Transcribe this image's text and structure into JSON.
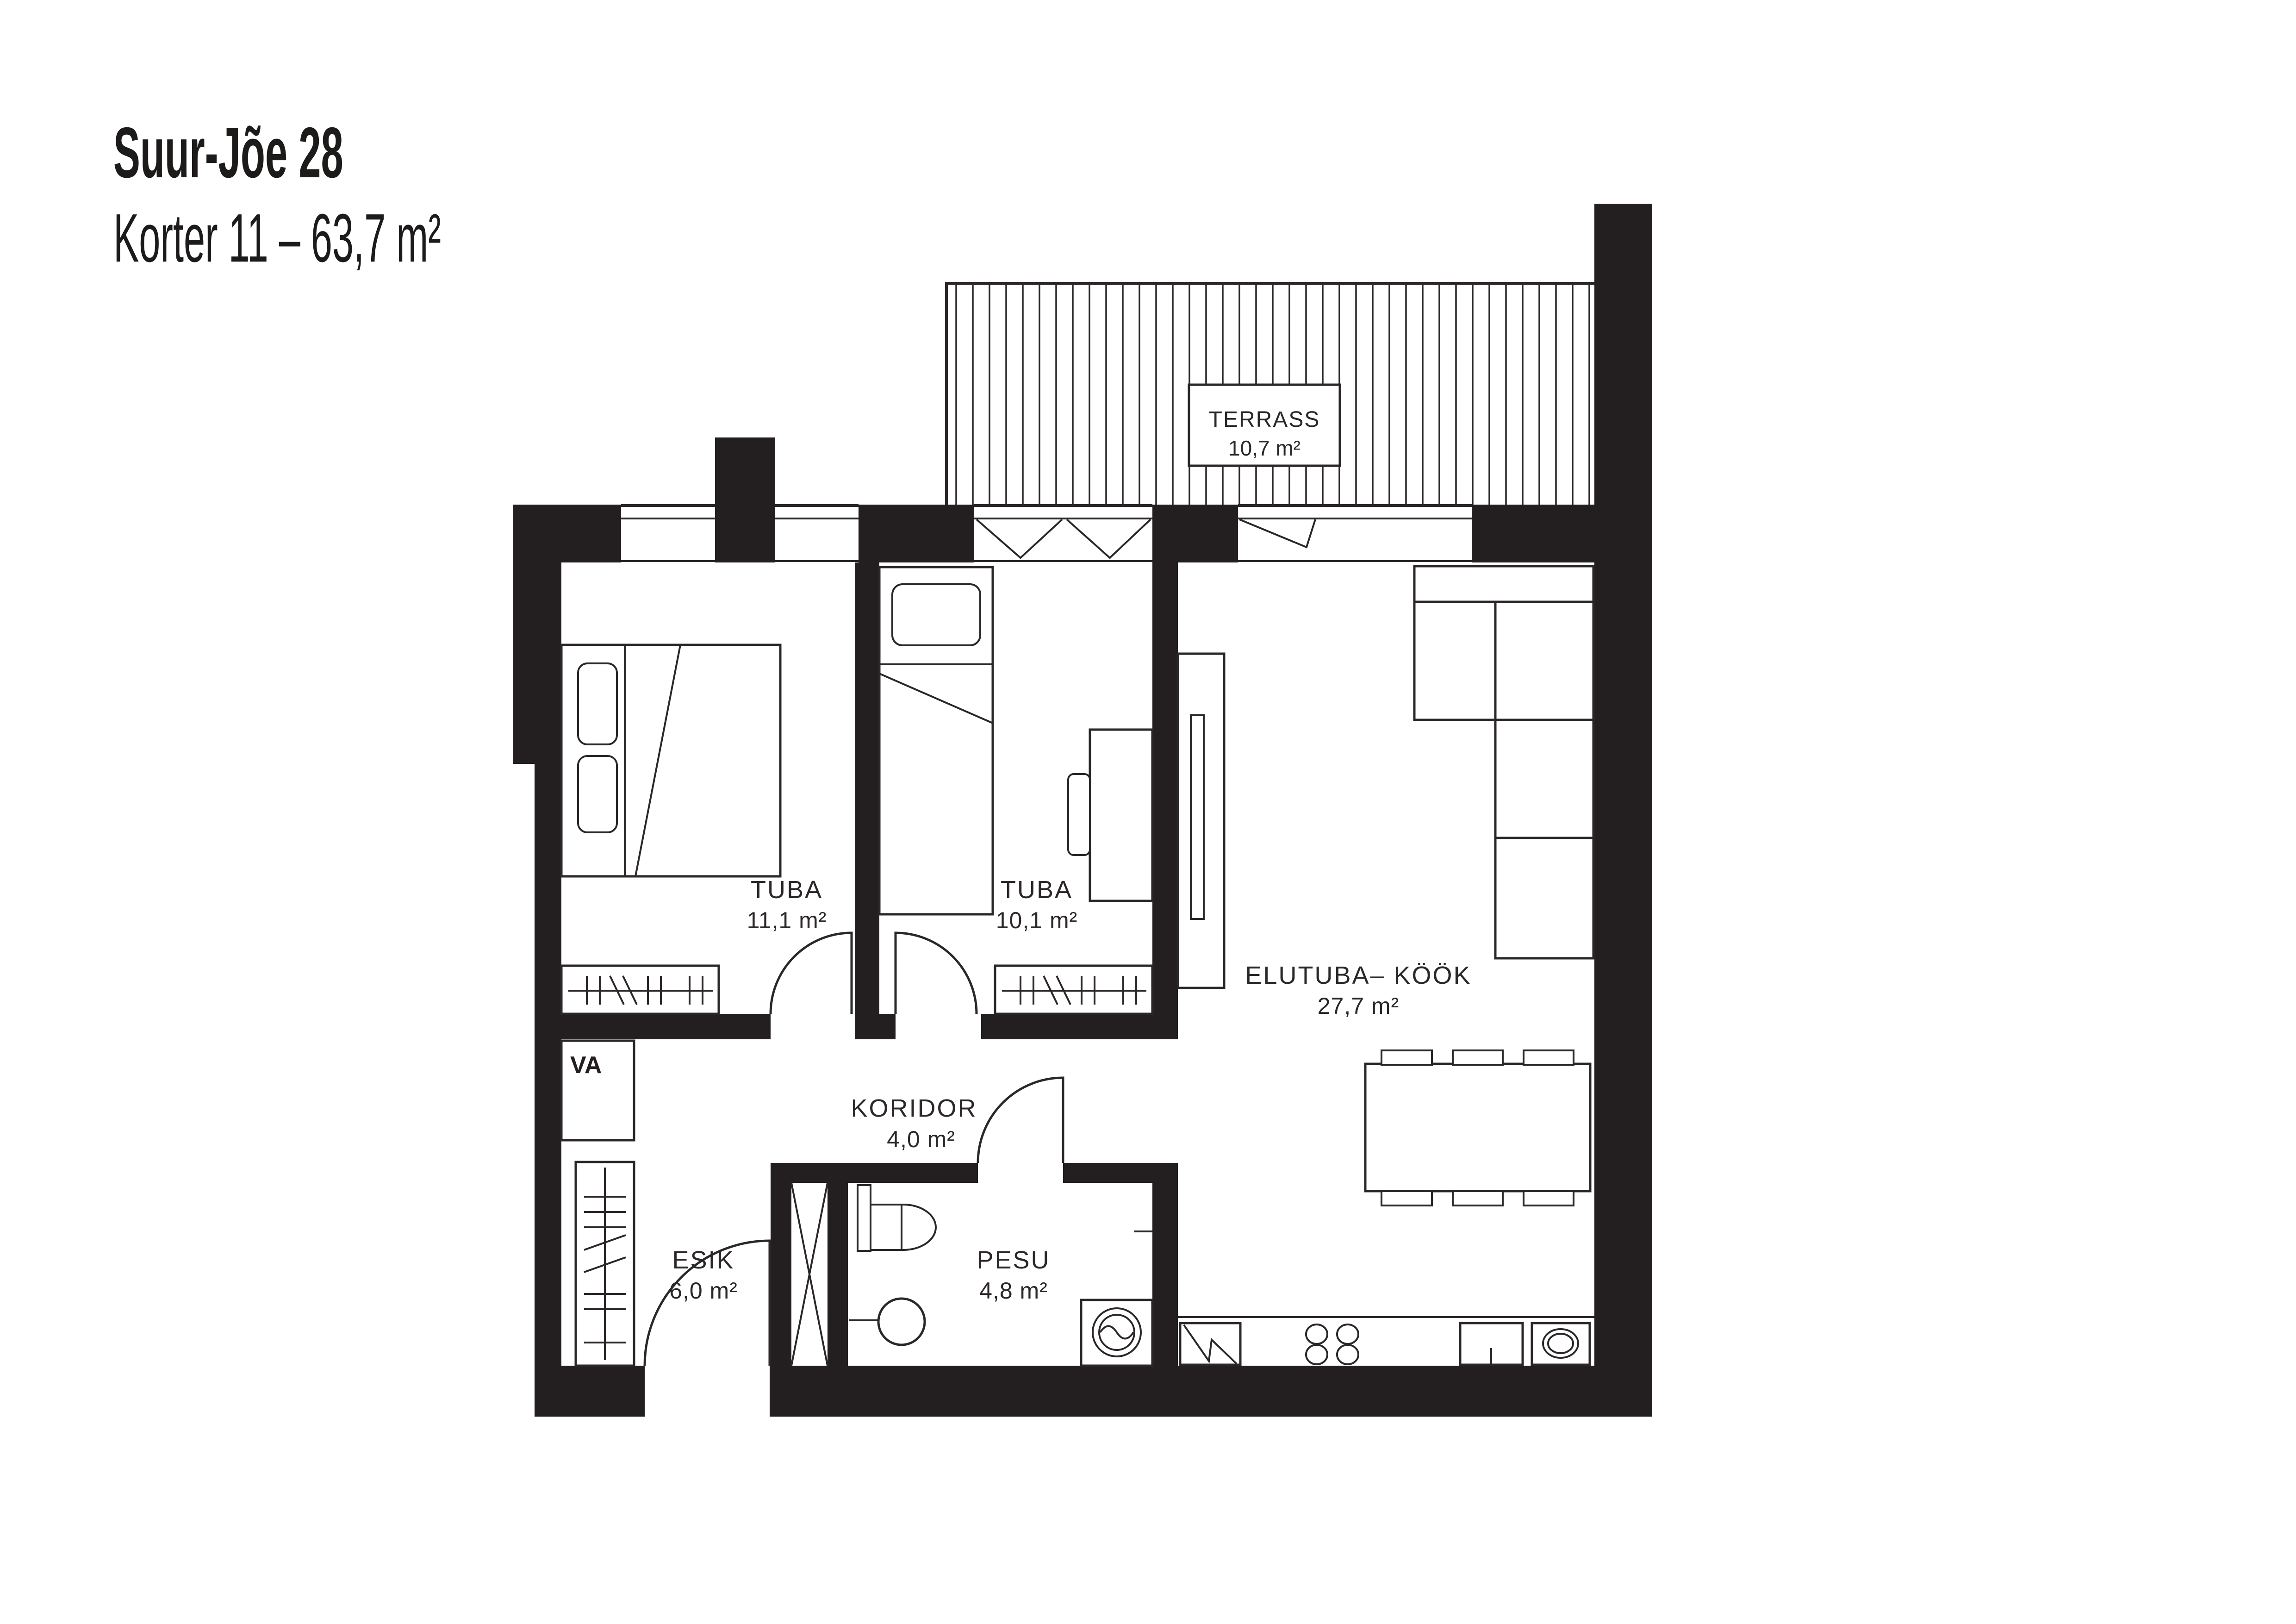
{
  "title": {
    "line1": "Suur-Jõe 28",
    "line2": "Korter 11 – 63,7 m²"
  },
  "rooms": {
    "terrass": {
      "name": "TERRASS",
      "area": "10,7 m²"
    },
    "tuba1": {
      "name": "TUBA",
      "area": "11,1 m²"
    },
    "tuba2": {
      "name": "TUBA",
      "area": "10,1 m²"
    },
    "elutuba": {
      "name": "ELUTUBA– KÖÖK",
      "area": "27,7 m²"
    },
    "koridor": {
      "name": "KORIDOR",
      "area": "4,0 m²"
    },
    "esik": {
      "name": "ESIK",
      "area": "6,0 m²"
    },
    "pesu": {
      "name": "PESU",
      "area": "4,8 m²"
    },
    "shaft": {
      "label": "VA"
    }
  },
  "colors": {
    "wall": "#231f20",
    "line": "#2b2728",
    "paper": "#ffffff"
  }
}
